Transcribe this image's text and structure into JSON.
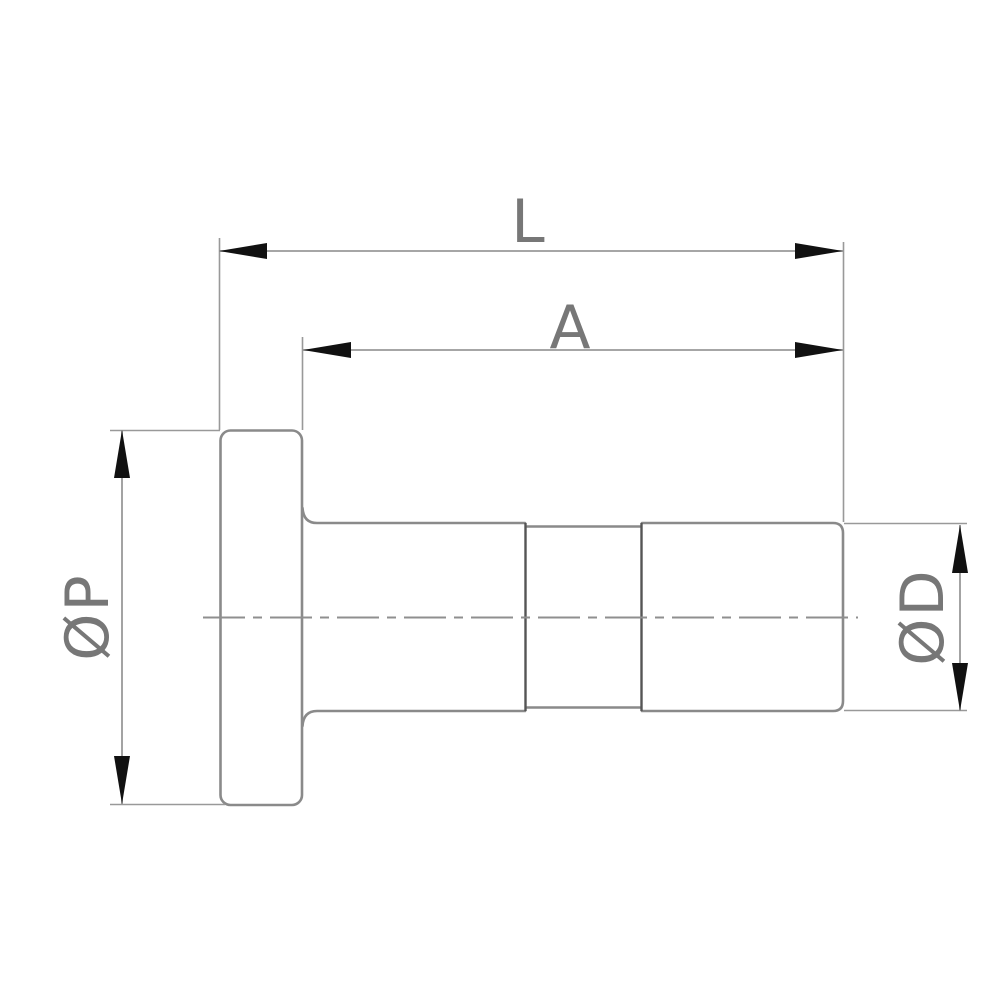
{
  "page": {
    "background": "#ffffff",
    "description": "Technical line drawing: side view of a flanged plug fitting with dimension callouts"
  },
  "drawing": {
    "view": "side-view-flanged-fitting",
    "labels": {
      "overall_length": "L",
      "body_length": "A",
      "flange_diameter": "ØP",
      "tube_diameter": "ØD"
    },
    "colors": {
      "outline": "#8a8a8a",
      "section_line": "#555555",
      "dimension_line": "#999999",
      "extension_line": "#999999",
      "centerline": "#8f8f8f",
      "arrowhead": "#111111",
      "label_text": "#777777",
      "background": "#ffffff"
    }
  }
}
